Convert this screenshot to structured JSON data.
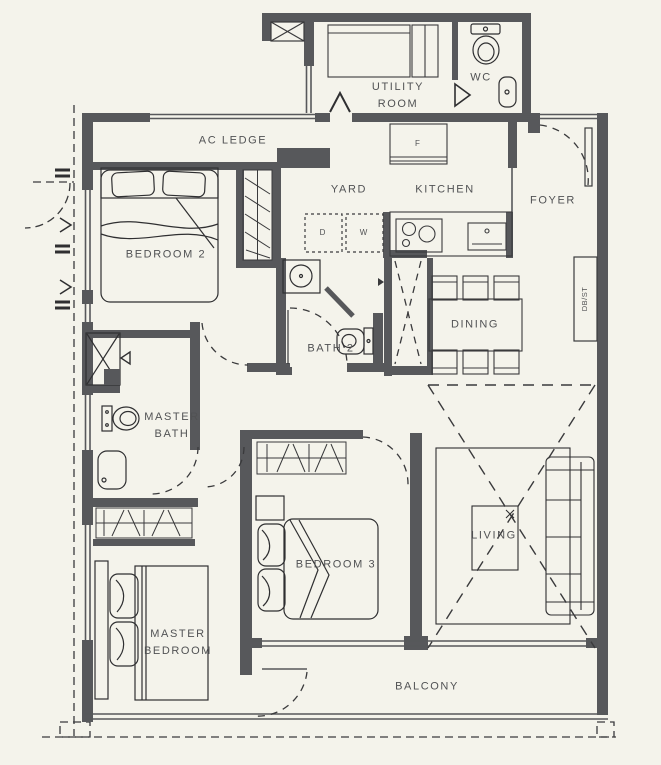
{
  "palette": {
    "background": "#F4F3EB",
    "wall": "#57585B",
    "line": "#3A3A3C",
    "text": "#515254"
  },
  "labels": {
    "ac_ledge": "AC LEDGE",
    "utility_room": "UTILITY ROOM",
    "wc": "WC",
    "bedroom_2": "BEDROOM 2",
    "yard": "YARD",
    "kitchen": "KITCHEN",
    "foyer": "FOYER",
    "dining": "DINING",
    "bath_2": "BATH 2",
    "master_bath": "MASTER BATH",
    "bedroom_3": "BEDROOM 3",
    "living": "LIVING",
    "master_bedroom": "MASTER BEDROOM",
    "balcony": "BALCONY"
  },
  "appliances": {
    "dryer": "D",
    "washer": "W",
    "fridge": "F",
    "db_st": "DB/ST"
  }
}
